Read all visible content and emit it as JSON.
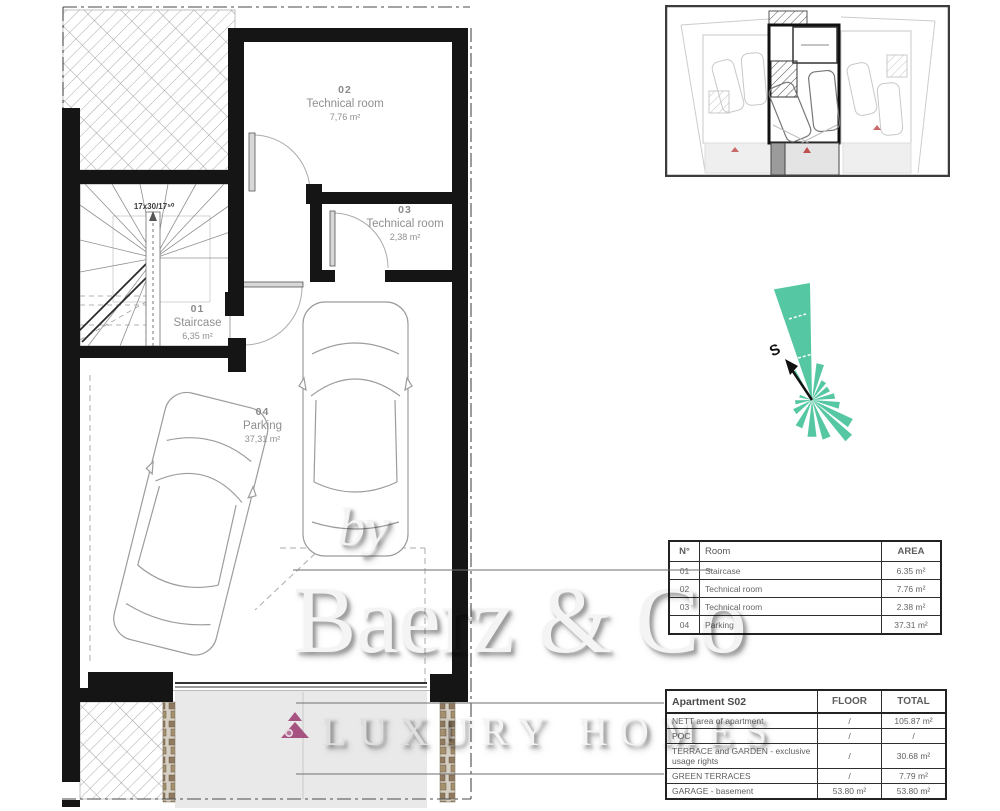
{
  "plan": {
    "stair_note": "17x30/17⁵⁰",
    "rooms": [
      {
        "num": "02",
        "name": "Technical room",
        "area": "7,76 m²"
      },
      {
        "num": "03",
        "name": "Technical room",
        "area": "2,38 m²"
      },
      {
        "num": "01",
        "name": "Staircase",
        "area": "6,35 m²"
      },
      {
        "num": "04",
        "name": "Parking",
        "area": "37,31 m²"
      }
    ]
  },
  "compass": {
    "south_label": "S",
    "wedges": [
      {
        "a": -10,
        "r": 117,
        "w": 9
      },
      {
        "a": -32,
        "r": 34,
        "w": 3
      },
      {
        "a": 13,
        "r": 37,
        "w": 6
      },
      {
        "a": 33,
        "r": 22,
        "w": 7
      },
      {
        "a": 56,
        "r": 20,
        "w": 8
      },
      {
        "a": 80,
        "r": 23,
        "w": 7
      },
      {
        "a": 101,
        "r": 28,
        "w": 7
      },
      {
        "a": 121,
        "r": 45,
        "w": 6
      },
      {
        "a": 136,
        "r": 53,
        "w": 5
      },
      {
        "a": 159,
        "r": 41,
        "w": 6
      },
      {
        "a": 180,
        "r": 37,
        "w": 7
      },
      {
        "a": 206,
        "r": 30,
        "w": 7
      },
      {
        "a": 236,
        "r": 21,
        "w": 8
      },
      {
        "a": 262,
        "r": 17,
        "w": 7
      },
      {
        "a": 287,
        "r": 13,
        "w": 6
      }
    ]
  },
  "room_table": {
    "headers": {
      "num": "N°",
      "room": "Room",
      "area": "AREA"
    },
    "rows": [
      {
        "num": "01",
        "room": "Staircase",
        "area": "6.35 m²"
      },
      {
        "num": "02",
        "room": "Technical room",
        "area": "7.76 m²"
      },
      {
        "num": "03",
        "room": "Technical room",
        "area": "2.38 m²"
      },
      {
        "num": "04",
        "room": "Parking",
        "area": "37.31 m²"
      }
    ]
  },
  "apartment_table": {
    "title": "Apartment S02",
    "floor_header": "FLOOR",
    "total_header": "TOTAL",
    "rows": [
      {
        "label": "NETT area of apartment",
        "floor": "/",
        "total": "105.87 m²"
      },
      {
        "label": "POC",
        "floor": "/",
        "total": "/"
      },
      {
        "label": "TERRACE and GARDEN - exclusive usage rights",
        "floor": "/",
        "total": "30.68 m²"
      },
      {
        "label": "GREEN TERRACES",
        "floor": "/",
        "total": "7.79 m²"
      },
      {
        "label": "GARAGE - basement",
        "floor": "53.80 m²",
        "total": "53.80 m²"
      }
    ]
  },
  "watermark": {
    "prefix": "by",
    "brand": "Baerz & Co",
    "tagline": "LUXURY HOMES"
  },
  "colors": {
    "teal": "#55c7a2",
    "logo_maroon": "#a1477a",
    "wall_black": "#151515",
    "driveway_gray": "#e9e9e9"
  }
}
